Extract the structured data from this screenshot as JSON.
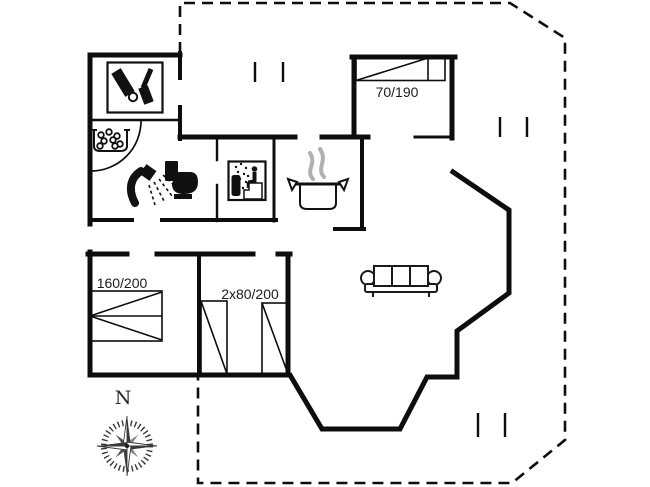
{
  "plan": {
    "type": "holiday-house-floor-plan",
    "labels": {
      "bed_single": "70/190",
      "bed_double": "160/200",
      "bed_twin": "2x80/200",
      "north": "N"
    },
    "icons": [
      "boots-icon",
      "whirlpool-icon",
      "shower-icon",
      "toilet-icon",
      "sauna-icon",
      "cooking-pot-icon",
      "sofa-icon",
      "compass-rose-icon"
    ],
    "colors": {
      "wall": "#0d0d0d",
      "background": "#ffffff",
      "steam": "#b0b0b0",
      "compass_dark": "#3a3a3a",
      "compass_mid": "#8a8a8a"
    }
  }
}
